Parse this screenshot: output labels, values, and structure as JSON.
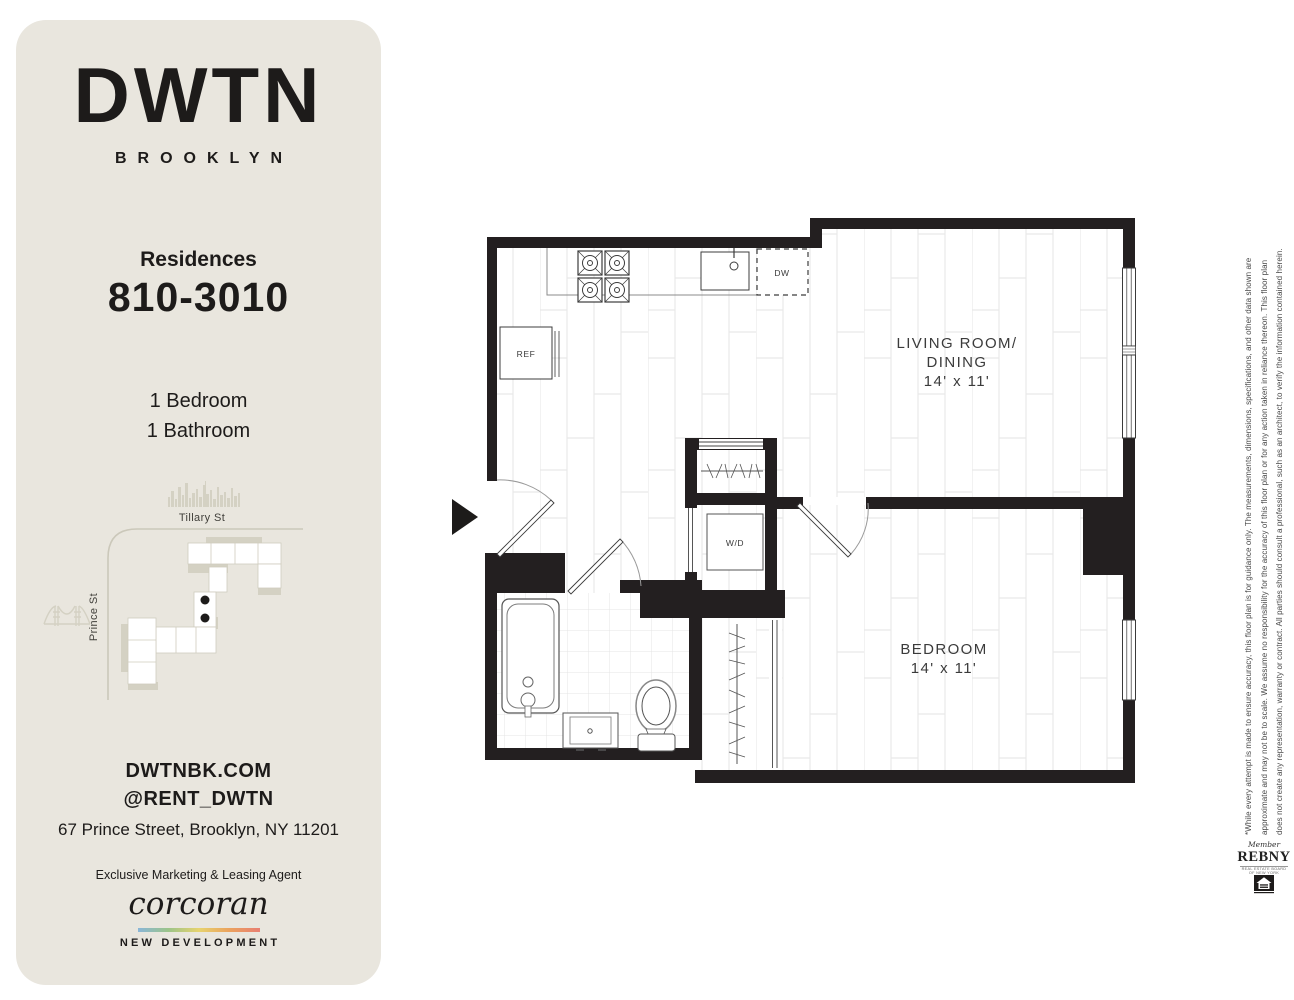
{
  "sidebar": {
    "brand": {
      "name": "DWTN",
      "location": "BROOKLYN"
    },
    "residences_label": "Residences",
    "unit_range": "810-3010",
    "features": [
      "1 Bedroom",
      "1 Bathroom"
    ],
    "map": {
      "street_top": "Tillary St",
      "street_left": "Prince St"
    },
    "website": "DWTNBK.COM",
    "instagram": "@RENT_DWTN",
    "address": "67 Prince Street, Brooklyn, NY 11201",
    "agent_label": "Exclusive Marketing & Leasing Agent",
    "agent_name": "corcoran",
    "agent_tagline": "NEW DEVELOPMENT"
  },
  "floorplan": {
    "living_room": {
      "name_line1": "LIVING ROOM/",
      "name_line2": "DINING",
      "dimensions": "14' x 11'"
    },
    "bedroom": {
      "name": "BEDROOM",
      "dimensions": "14' x 11'"
    },
    "appliances": {
      "refrigerator": "REF",
      "dishwasher": "DW",
      "washer_dryer": "W/D"
    }
  },
  "disclaimer": {
    "line1": "*While every attempt is made to ensure accuracy, this floor plan is for guidance only. The measurements, dimensions, specifications, and other data shown are",
    "line2": "approximate and may not be to scale. We assume no responsibility for the accuracy of this floor plan or for any action taken in reliance thereon. This floor plan",
    "line3": "does not create any representation, warranty or contract. All parties should consult a professional, such as an architect, to verify the information contained herein."
  },
  "footer": {
    "rebny_member": "Member",
    "rebny_name": "REBNY",
    "rebny_caption": "REAL ESTATE BOARD OF NEW YORK"
  },
  "colors": {
    "sidebar_bg": "#e9e6de",
    "ink": "#1d1b1a",
    "wall": "#231f20",
    "map_gray": "#d4d1c3",
    "corcoran_gradient": [
      "#8ab6d8",
      "#9cc489",
      "#e7d36e",
      "#eba25e",
      "#e87f72"
    ]
  }
}
